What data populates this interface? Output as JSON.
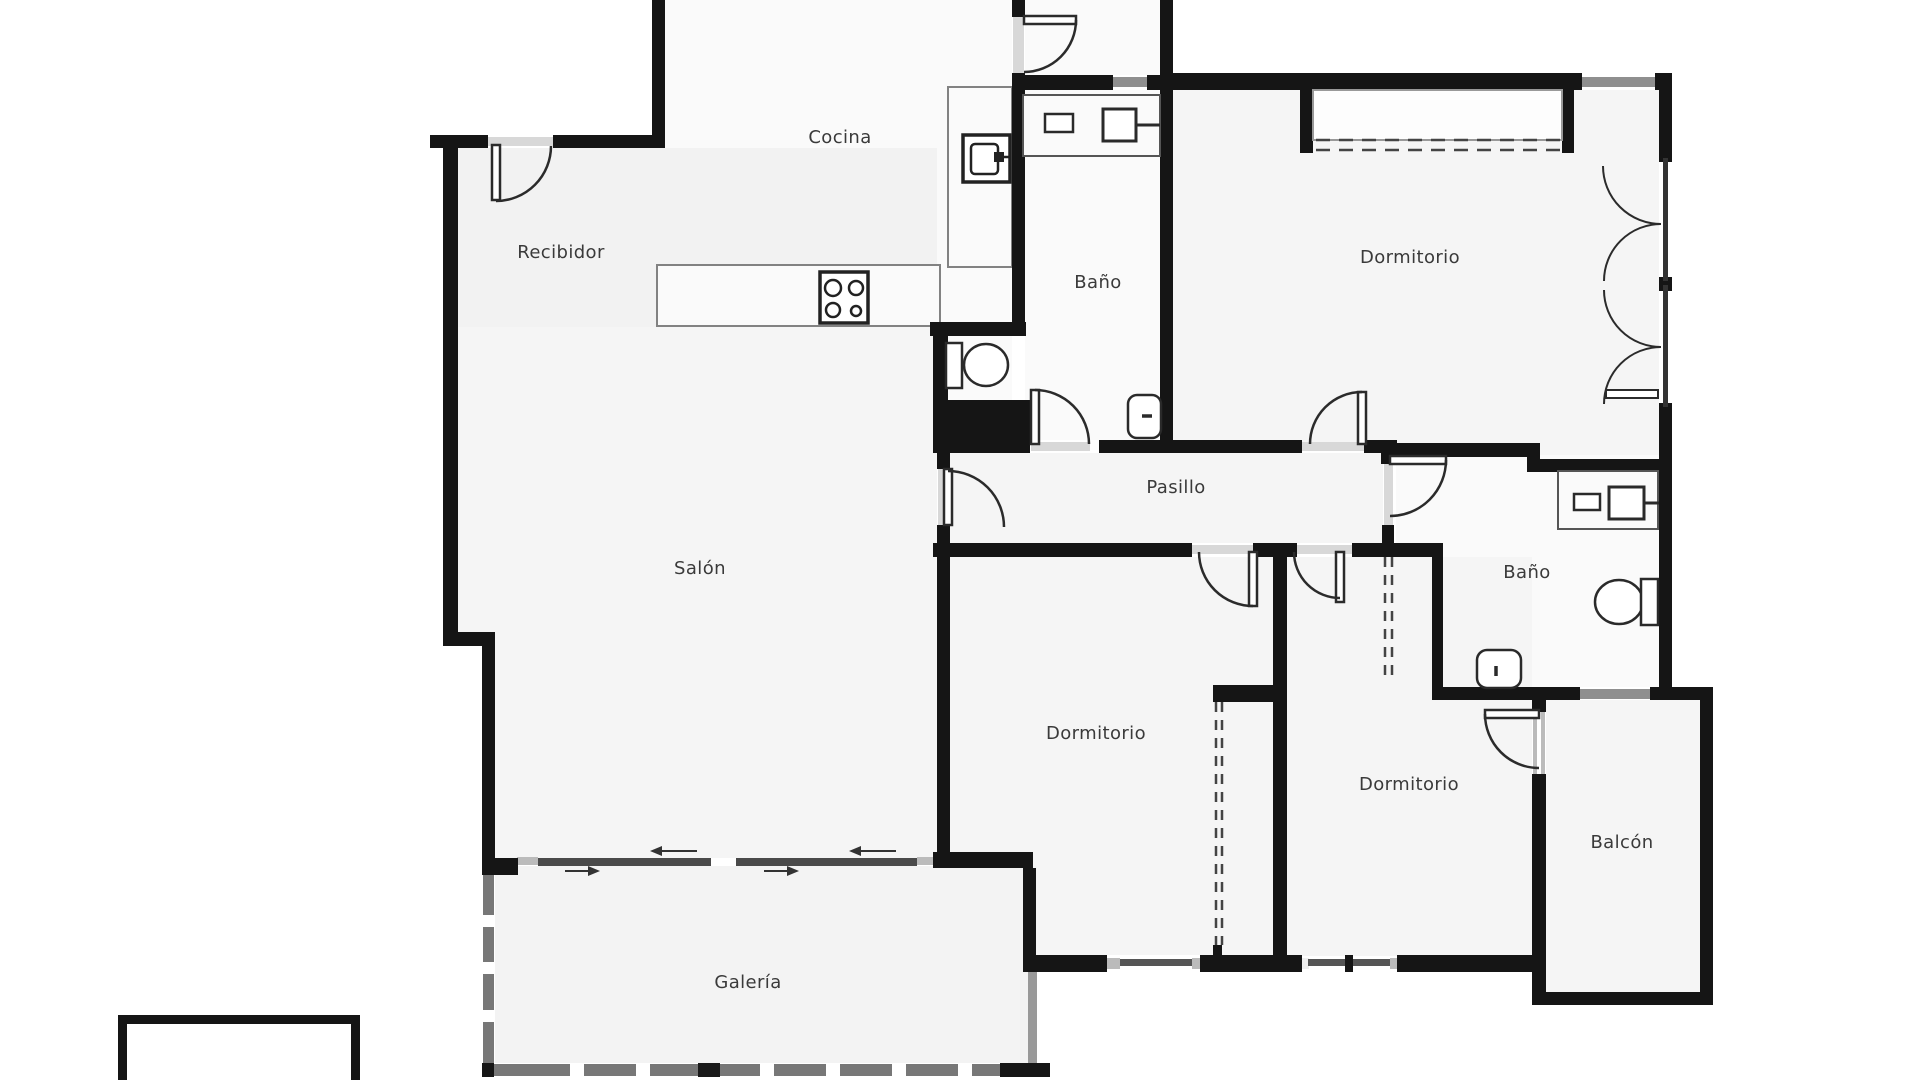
{
  "floorplan": {
    "title": "Apartment floor plan",
    "rooms": [
      {
        "id": "recibidor",
        "label": "Recibidor"
      },
      {
        "id": "cocina",
        "label": "Cocina"
      },
      {
        "id": "bano-superior",
        "label": "Baño"
      },
      {
        "id": "dormitorio-principal",
        "label": "Dormitorio"
      },
      {
        "id": "pasillo",
        "label": "Pasillo"
      },
      {
        "id": "salon",
        "label": "Salón"
      },
      {
        "id": "bano-derecho",
        "label": "Baño"
      },
      {
        "id": "dormitorio-central",
        "label": "Dormitorio"
      },
      {
        "id": "dormitorio-derecho",
        "label": "Dormitorio"
      },
      {
        "id": "balcon",
        "label": "Balcón"
      },
      {
        "id": "galeria",
        "label": "Galería"
      }
    ],
    "fixtures": [
      "stove-icon",
      "oven-icon",
      "sink-icon",
      "toilet-icon",
      "bidet-icon",
      "sink-icon",
      "toilet-icon",
      "bidet-icon",
      "wardrobe-dashed",
      "sliding-door-arrows"
    ],
    "colors": {
      "wall": "#151515",
      "room_fill": "#f5f5f5",
      "room_fill_light": "#fafafa",
      "window": "#8f8f8f",
      "window_dark": "#4a4a4a",
      "sill": "#d8d8d8",
      "door_stroke": "#2b2b2b",
      "label_text": "#3a3a3a",
      "background": "#ffffff"
    }
  }
}
